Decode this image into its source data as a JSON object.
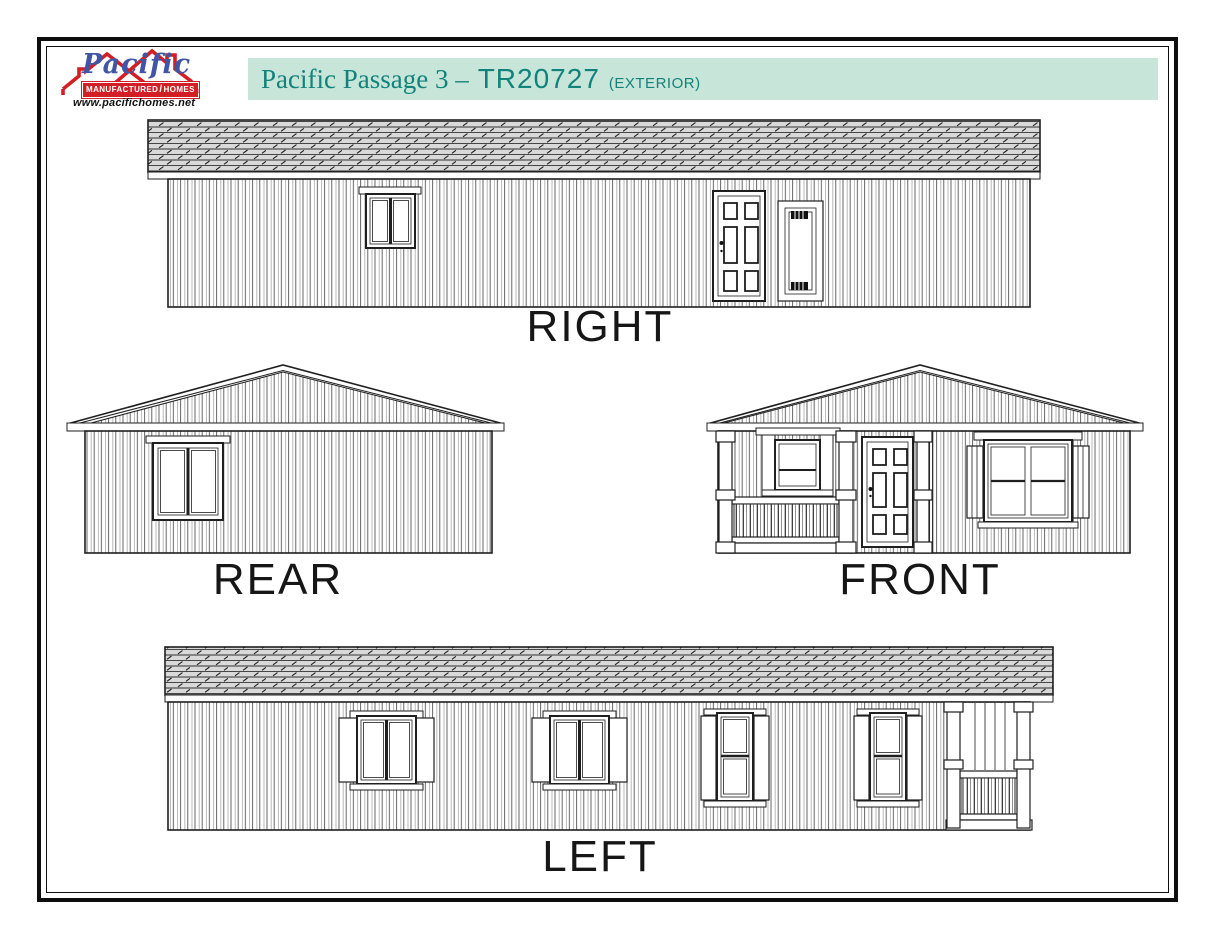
{
  "header": {
    "logo": {
      "brand": "Pacific",
      "band_left": "MANUFACTURED",
      "band_slash": "/",
      "band_right": "HOMES",
      "registered": "®",
      "url": "www.pacifichomes.net",
      "brand_color": "#4254a5",
      "accent_color": "#d21f26"
    },
    "banner": {
      "series": "Pacific Passage 3 –",
      "model": "TR20727",
      "view": "(EXTERIOR)",
      "bg_color": "#c7e5d9",
      "text_color": "#12837b"
    }
  },
  "elevations": {
    "right": {
      "label": "RIGHT",
      "features": [
        "two-pane window",
        "six-panel entry door",
        "utility access panel"
      ]
    },
    "rear": {
      "label": "REAR",
      "features": [
        "two-pane slider window"
      ]
    },
    "front": {
      "label": "FRONT",
      "features": [
        "covered porch with railing",
        "porch window",
        "six-panel entry door",
        "double window with shutters"
      ]
    },
    "left": {
      "label": "LEFT",
      "features": [
        "two slider windows with shutters",
        "two single-hung windows with shutters",
        "porch end with railing"
      ]
    }
  },
  "drawing_style": {
    "line_color": "#1f1f1f",
    "roof_fill": "#d9d9d9",
    "paper_color": "#ffffff"
  }
}
